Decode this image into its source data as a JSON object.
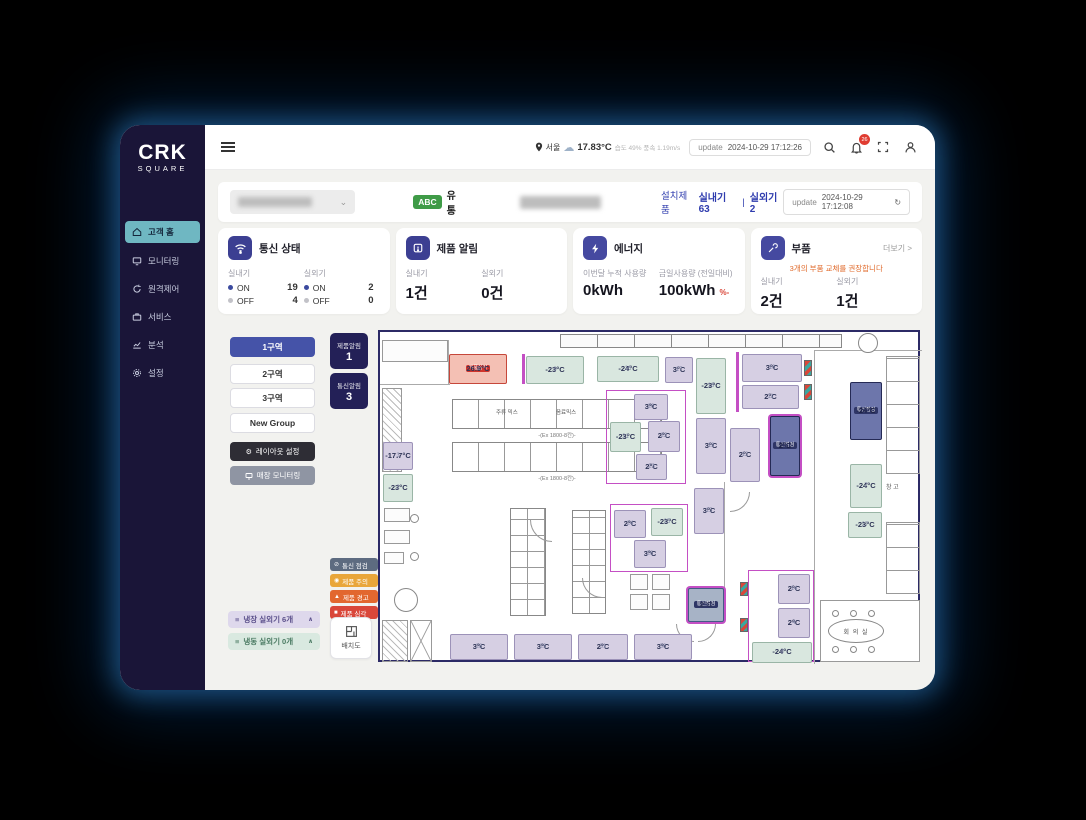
{
  "topbar": {
    "location": "서울",
    "temperature": "17.83°C",
    "weather_detail": "습도 49% 풍속 1.19m/s",
    "update_label": "update",
    "update_time": "2024-10-29 17:12:26",
    "bell_badge": "26"
  },
  "sidebar": {
    "logo_top": "CRK",
    "logo_bottom": "SQUARE",
    "items": [
      {
        "label": "고객 홈",
        "active": true
      },
      {
        "label": "모니터링"
      },
      {
        "label": "원격제어"
      },
      {
        "label": "서비스"
      },
      {
        "label": "분석"
      },
      {
        "label": "설정"
      }
    ]
  },
  "header": {
    "brand_badge": "ABC",
    "brand_name": "유통",
    "installed_label": "설치제품",
    "indoor_count": "실내기 63",
    "divider": "|",
    "outdoor_count": "실외기 2",
    "update_label": "update",
    "update_time": "2024-10-29 17:12:08"
  },
  "cards": {
    "comm": {
      "title": "통신 상태",
      "indoor_label": "실내기",
      "outdoor_label": "실외기",
      "on_label": "ON",
      "off_label": "OFF",
      "indoor_on": "19",
      "indoor_off": "4",
      "outdoor_on": "2",
      "outdoor_off": "0"
    },
    "alarm": {
      "title": "제품 알림",
      "indoor_label": "실내기",
      "outdoor_label": "실외기",
      "indoor_value": "1건",
      "outdoor_value": "0건"
    },
    "energy": {
      "title": "에너지",
      "monthly_label": "이번달 누적 사용량",
      "monthly_value": "0kWh",
      "daily_label": "금일사용량 (전일대비)",
      "daily_value": "100kWh",
      "daily_delta": "%-"
    },
    "parts": {
      "title": "부품",
      "more_label": "더보기 >",
      "notice": "3개의 부품 교체를 권장합니다",
      "indoor_label": "실내기",
      "outdoor_label": "실외기",
      "indoor_value": "2건",
      "outdoor_value": "1건"
    }
  },
  "groups": {
    "zones": [
      {
        "label": "1구역",
        "active": true
      },
      {
        "label": "2구역"
      },
      {
        "label": "3구역"
      },
      {
        "label": "New Group"
      }
    ],
    "layout_button": "레이아웃 설정",
    "monitoring_button": "매장 모니터링",
    "fridge_accordion": "냉장 실외기 6개",
    "freezer_accordion": "냉동 실외기 0개"
  },
  "alert_tiles": {
    "product_label": "제품알림",
    "product_count": "1",
    "comm_label": "통신알림",
    "comm_count": "3"
  },
  "legend": {
    "items": [
      {
        "label": "통신 점검",
        "color": "#5d6b80"
      },
      {
        "label": "제품 주의",
        "color": "#e9a63a"
      },
      {
        "label": "제품 경고",
        "color": "#e2672f"
      },
      {
        "label": "제품 심각",
        "color": "#d9473a"
      }
    ],
    "map_button": "배치도"
  },
  "floorplan": {
    "rack_label_1": "주류 믹스",
    "rack_label_2": "음료믹스",
    "rack_caption_1": "-(Ex 1800-8칸)-",
    "rack_caption_2": "-(Ex 1800-8칸)-",
    "warehouse_label": "창 고",
    "meeting_room_label": "회 의 실",
    "badge_critical": "제품심각",
    "badge_comm": "통신점검",
    "units": [
      {
        "num": "1",
        "temp": "26.9°C",
        "type": "red",
        "badge": "제품심각",
        "badge_cls": "red",
        "x": 69,
        "y": 22,
        "w": 58,
        "h": 30
      },
      {
        "num": "9",
        "temp": "-23°C",
        "type": "mint",
        "x": 146,
        "y": 24,
        "w": 58,
        "h": 28,
        "pinkbar": true
      },
      {
        "num": "16",
        "temp": "-24°C",
        "type": "mint",
        "x": 217,
        "y": 24,
        "w": 62,
        "h": 26
      },
      {
        "num": "17",
        "temp": "3°C",
        "type": "lav",
        "x": 285,
        "y": 25,
        "w": 28,
        "h": 26
      },
      {
        "num": "18",
        "temp": "-23°C",
        "type": "mint",
        "x": 316,
        "y": 26,
        "w": 30,
        "h": 56
      },
      {
        "num": "10",
        "temp": "3°C",
        "type": "lav",
        "x": 362,
        "y": 22,
        "w": 60,
        "h": 28
      },
      {
        "num": "11",
        "temp": "2°C",
        "type": "lav",
        "x": 362,
        "y": 53,
        "w": 57,
        "h": 24
      },
      {
        "num": "20",
        "temp": "3°C",
        "type": "lav",
        "x": 254,
        "y": 62,
        "w": 34,
        "h": 26
      },
      {
        "num": "21",
        "temp": "-23°C",
        "type": "mint",
        "x": 230,
        "y": 90,
        "w": 31,
        "h": 30
      },
      {
        "num": "22",
        "temp": "2°C",
        "type": "lav",
        "x": 268,
        "y": 89,
        "w": 32,
        "h": 31
      },
      {
        "num": "23",
        "temp": "2°C",
        "type": "lav",
        "x": 256,
        "y": 122,
        "w": 31,
        "h": 26
      },
      {
        "num": "19",
        "temp": "3°C",
        "type": "lav",
        "x": 316,
        "y": 86,
        "w": 30,
        "h": 56
      },
      {
        "num": "12",
        "temp": "2°C",
        "type": "lav",
        "x": 350,
        "y": 96,
        "w": 30,
        "h": 54
      },
      {
        "num": "13",
        "temp": "2°C",
        "type": "navy",
        "badge": "통신점검",
        "badge_cls": "navy",
        "ring": true,
        "x": 390,
        "y": 84,
        "w": 30,
        "h": 60
      },
      {
        "num": "6",
        "temp": "-24°C",
        "type": "navy",
        "badge": "통신점검",
        "badge_cls": "navy",
        "x": 470,
        "y": 50,
        "w": 32,
        "h": 58
      },
      {
        "num": "7",
        "temp": "-24°C",
        "type": "mint",
        "x": 470,
        "y": 132,
        "w": 32,
        "h": 44
      },
      {
        "num": "3",
        "temp": "-17.7°C",
        "type": "lav",
        "x": 3,
        "y": 110,
        "w": 30,
        "h": 28
      },
      {
        "num": "2",
        "temp": "-23°C",
        "type": "mint",
        "x": 3,
        "y": 142,
        "w": 30,
        "h": 28
      },
      {
        "num": "15",
        "temp": "3°C",
        "type": "lav",
        "x": 314,
        "y": 156,
        "w": 30,
        "h": 46
      },
      {
        "num": "24",
        "temp": "2°C",
        "type": "lav",
        "x": 234,
        "y": 178,
        "w": 32,
        "h": 28
      },
      {
        "num": "25",
        "temp": "-23°C",
        "type": "mint",
        "x": 271,
        "y": 176,
        "w": 32,
        "h": 28
      },
      {
        "num": "26",
        "temp": "3°C",
        "type": "lav",
        "x": 254,
        "y": 208,
        "w": 32,
        "h": 28
      },
      {
        "num": "27",
        "temp": "-23°C",
        "type": "mint",
        "x": 468,
        "y": 180,
        "w": 34,
        "h": 26
      },
      {
        "num": "5",
        "temp": "2°C",
        "type": "slate",
        "badge": "통신점검",
        "badge_cls": "navy",
        "ring": true,
        "x": 308,
        "y": 256,
        "w": 36,
        "h": 34
      },
      {
        "num": "14",
        "temp": "2°C",
        "type": "lav",
        "x": 398,
        "y": 242,
        "w": 32,
        "h": 30
      },
      {
        "num": "4",
        "temp": "2°C",
        "type": "lav",
        "x": 398,
        "y": 276,
        "w": 32,
        "h": 30
      },
      {
        "num": "8",
        "temp": "-24°C",
        "type": "mint",
        "x": 372,
        "y": 310,
        "w": 60,
        "h": 21
      },
      {
        "num": "28",
        "temp": "3°C",
        "type": "lav",
        "x": 70,
        "y": 302,
        "w": 58,
        "h": 26
      },
      {
        "num": "29",
        "temp": "3°C",
        "type": "lav",
        "x": 134,
        "y": 302,
        "w": 58,
        "h": 26
      },
      {
        "num": "31",
        "temp": "2°C",
        "type": "lav",
        "x": 198,
        "y": 302,
        "w": 50,
        "h": 26
      },
      {
        "num": "30",
        "temp": "3°C",
        "type": "lav",
        "x": 254,
        "y": 302,
        "w": 58,
        "h": 26
      }
    ]
  }
}
